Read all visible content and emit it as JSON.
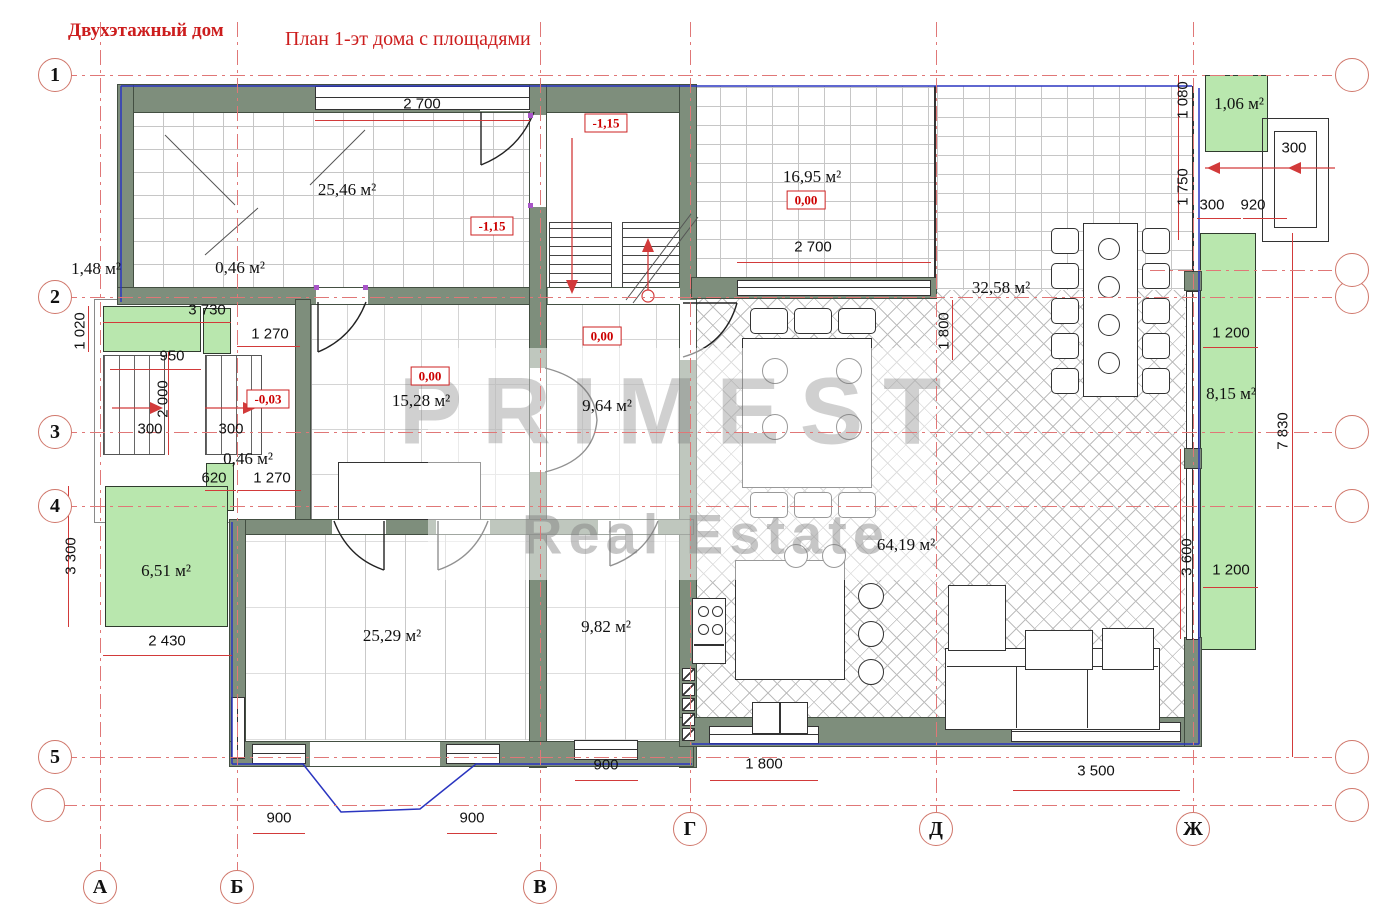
{
  "title": "Двухэтажный дом",
  "subtitle": "План 1-эт дома с площадями",
  "watermark": {
    "line1": "PRIMEST",
    "line2": "Real Estate"
  },
  "colors": {
    "wall": "#7e8e7c",
    "porch_green": "#b9e7ae",
    "annotation_red": "#cc2222",
    "axis_red": "#e07777",
    "outline_blue": "#2a35c0"
  },
  "axes": {
    "rows": [
      "1",
      "2",
      "3",
      "4",
      "5"
    ],
    "cols": [
      "А",
      "Б",
      "В",
      "Г",
      "Д",
      "Ж"
    ]
  },
  "areas": [
    "25,46 м²",
    "16,95 м²",
    "1,06 м²",
    "1,48 м²",
    "0,46 м²",
    "15,28 м²",
    "9,64 м²",
    "32,58 м²",
    "8,15 м²",
    "0,46 м²",
    "6,51 м²",
    "25,29 м²",
    "9,82 м²",
    "64,19 м²"
  ],
  "dims_h": [
    "2 700",
    "2 700",
    "3 730",
    "1 270",
    "950",
    "300",
    "300",
    "620",
    "1 270",
    "2 430",
    "900",
    "900",
    "900",
    "1 800",
    "3 500",
    "300",
    "920",
    "300",
    "1 200",
    "1 200"
  ],
  "dims_v": [
    "1 020",
    "2 000",
    "3 300",
    "1 080",
    "1 750",
    "1 800",
    "7 830",
    "3 600"
  ],
  "elevations": [
    "-1,15",
    "-1,15",
    "0,00",
    "0,00",
    "0,00",
    "-0,03"
  ]
}
